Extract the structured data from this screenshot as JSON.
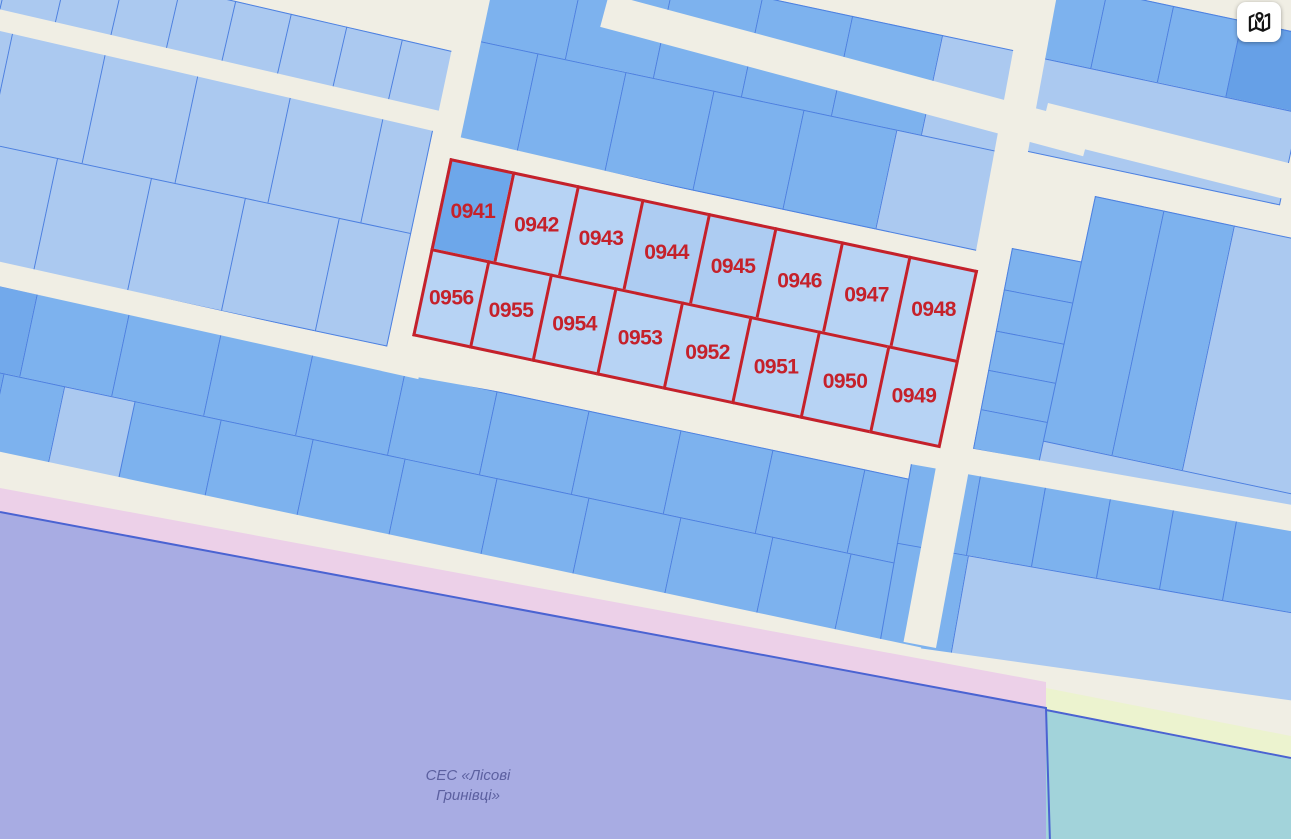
{
  "map": {
    "street_color": "#f0eee4",
    "parcel_border_color": "#4d80e0",
    "red_outline_color": "#c5212a",
    "palette": {
      "light": "#abc9f0",
      "light2": "#b7d3f4",
      "light3": "#adccf2",
      "med": "#7db2ee",
      "med2": "#72a9eb",
      "dark": "#66a0e7",
      "medDark": "#6da7ea"
    },
    "highlighted_parcels": [
      "0941",
      "0942",
      "0943",
      "0944",
      "0945",
      "0946",
      "0947",
      "0948",
      "0949",
      "0950",
      "0951",
      "0952",
      "0953",
      "0954",
      "0955",
      "0956"
    ],
    "blocks": [
      {
        "name": "block-nw-strip",
        "x": -20,
        "y": -58,
        "angle": 13,
        "rows": [
          {
            "h": 74,
            "cells": [
              {
                "w": 34,
                "c": "light"
              },
              {
                "w": 57,
                "c": "light"
              },
              {
                "w": 57,
                "c": "light"
              },
              {
                "w": 57,
                "c": "light"
              },
              {
                "w": 57,
                "c": "light"
              },
              {
                "w": 57,
                "c": "light"
              },
              {
                "w": 57,
                "c": "light"
              },
              {
                "w": 57,
                "c": "light"
              },
              {
                "w": 57,
                "c": "light"
              },
              {
                "w": 40,
                "c": "light"
              }
            ]
          }
        ]
      },
      {
        "name": "block-west-upper",
        "x": -15,
        "y": 26,
        "angle": 12,
        "rows": [
          {
            "h": 114,
            "cells": [
              {
                "w": 28,
                "c": "light"
              },
              {
                "w": 95,
                "c": "light"
              },
              {
                "w": 95,
                "c": "light"
              },
              {
                "w": 95,
                "c": "light"
              },
              {
                "w": 95,
                "c": "light"
              },
              {
                "w": 52,
                "c": "light"
              }
            ]
          },
          {
            "h": 116,
            "cells": [
              {
                "w": 16,
                "c": "light"
              },
              {
                "w": 82,
                "c": "light"
              },
              {
                "w": 96,
                "c": "light"
              },
              {
                "w": 96,
                "c": "light"
              },
              {
                "w": 96,
                "c": "light"
              },
              {
                "w": 74,
                "c": "light"
              }
            ]
          }
        ]
      },
      {
        "name": "block-north-central",
        "x": 500,
        "y": -59,
        "angle": 12,
        "rows": [
          {
            "h": 102,
            "cells": [
              {
                "w": 88,
                "c": "med"
              },
              {
                "w": 90,
                "c": "med"
              },
              {
                "w": 90,
                "c": "med"
              },
              {
                "w": 92,
                "c": "med"
              },
              {
                "w": 92,
                "c": "med"
              },
              {
                "w": 93,
                "c": "light"
              }
            ]
          },
          {
            "h": 102,
            "cells": [
              {
                "w": 60,
                "c": "med"
              },
              {
                "w": 90,
                "c": "med"
              },
              {
                "w": 90,
                "c": "med"
              },
              {
                "w": 92,
                "c": "med"
              },
              {
                "w": 95,
                "c": "med"
              },
              {
                "w": 118,
                "c": "light"
              }
            ]
          }
        ]
      },
      {
        "name": "block-northeast",
        "x": 1042,
        "y": -22,
        "angle": 12,
        "rows": [
          {
            "h": 78,
            "cells": [
              {
                "w": 66,
                "c": "med"
              },
              {
                "w": 68,
                "c": "med"
              },
              {
                "w": 70,
                "c": "med"
              },
              {
                "w": 76,
                "c": "dark"
              }
            ]
          },
          {
            "h": 95,
            "cells": [
              {
                "w": 280,
                "c": "light"
              }
            ]
          }
        ]
      },
      {
        "name": "block-east-strips",
        "x": 1012,
        "y": 248,
        "angle": 11,
        "rows": [
          {
            "h": 42,
            "cells": [
              {
                "w": 96,
                "c": "med"
              }
            ]
          },
          {
            "h": 42,
            "cells": [
              {
                "w": 96,
                "c": "med"
              }
            ]
          },
          {
            "h": 40,
            "cells": [
              {
                "w": 96,
                "c": "med"
              }
            ]
          },
          {
            "h": 40,
            "cells": [
              {
                "w": 96,
                "c": "med"
              }
            ]
          },
          {
            "h": 41,
            "cells": [
              {
                "w": 96,
                "c": "med"
              }
            ]
          }
        ]
      },
      {
        "name": "block-east-large",
        "x": 1095,
        "y": 196,
        "angle": 12,
        "rows": [
          {
            "h": 250,
            "cells": [
              {
                "w": 70,
                "c": "med"
              },
              {
                "w": 72,
                "c": "med"
              },
              {
                "w": 130,
                "c": "light"
              }
            ]
          },
          {
            "h": 130,
            "cells": [
              {
                "w": 272,
                "c": "light"
              }
            ]
          }
        ]
      },
      {
        "name": "block-west-lower",
        "x": -12,
        "y": 283,
        "angle": 12,
        "rows": [
          {
            "h": 85,
            "cells": [
              {
                "w": 50,
                "c": "med2"
              },
              {
                "w": 94,
                "c": "med"
              },
              {
                "w": 94,
                "c": "med"
              },
              {
                "w": 94,
                "c": "med"
              },
              {
                "w": 94,
                "c": "med"
              },
              {
                "w": 94,
                "c": "med"
              },
              {
                "w": 94,
                "c": "med"
              },
              {
                "w": 94,
                "c": "med"
              },
              {
                "w": 94,
                "c": "med"
              },
              {
                "w": 94,
                "c": "med"
              },
              {
                "w": 84,
                "c": "med"
              }
            ]
          },
          {
            "h": 85,
            "cells": [
              {
                "w": 34,
                "c": "med2"
              },
              {
                "w": 62,
                "c": "med"
              },
              {
                "w": 72,
                "c": "light"
              },
              {
                "w": 88,
                "c": "med"
              },
              {
                "w": 94,
                "c": "med"
              },
              {
                "w": 94,
                "c": "med"
              },
              {
                "w": 94,
                "c": "med"
              },
              {
                "w": 94,
                "c": "med"
              },
              {
                "w": 94,
                "c": "med"
              },
              {
                "w": 94,
                "c": "med"
              },
              {
                "w": 80,
                "c": "med"
              },
              {
                "w": 80,
                "c": "med"
              }
            ]
          }
        ]
      },
      {
        "name": "block-southeast",
        "x": 912,
        "y": 458,
        "angle": 10,
        "rows": [
          {
            "h": 86,
            "cells": [
              {
                "w": 70,
                "c": "med"
              },
              {
                "w": 66,
                "c": "med"
              },
              {
                "w": 66,
                "c": "med"
              },
              {
                "w": 64,
                "c": "med"
              },
              {
                "w": 64,
                "c": "med"
              },
              {
                "w": 90,
                "c": "med"
              }
            ]
          },
          {
            "h": 178,
            "cells": [
              {
                "w": 72,
                "c": "med"
              },
              {
                "w": 348,
                "c": "light"
              }
            ]
          }
        ]
      },
      {
        "name": "block-highlighted",
        "x": 450,
        "y": 158,
        "angle": 12,
        "highlight": true,
        "rows": [
          {
            "h": 92,
            "cells": [
              {
                "w": 64,
                "c": "medDark",
                "label": "0941"
              },
              {
                "w": 66,
                "c": "light2",
                "label": "0942"
              },
              {
                "w": 66,
                "c": "light2",
                "label": "0943"
              },
              {
                "w": 68,
                "c": "light3",
                "label": "0944"
              },
              {
                "w": 68,
                "c": "light3",
                "label": "0945"
              },
              {
                "w": 68,
                "c": "light2",
                "label": "0946"
              },
              {
                "w": 69,
                "c": "light2",
                "label": "0947"
              },
              {
                "w": 71,
                "c": "light2",
                "label": "0948"
              }
            ]
          },
          {
            "h": 90,
            "cells": [
              {
                "w": 58,
                "c": "light2",
                "label": "0956"
              },
              {
                "w": 64,
                "c": "light2",
                "label": "0955"
              },
              {
                "w": 66,
                "c": "light2",
                "label": "0954"
              },
              {
                "w": 68,
                "c": "light2",
                "label": "0953"
              },
              {
                "w": 70,
                "c": "light2",
                "label": "0952"
              },
              {
                "w": 70,
                "c": "light2",
                "label": "0951"
              },
              {
                "w": 71,
                "c": "light2",
                "label": "0950"
              },
              {
                "w": 73,
                "c": "light2",
                "label": "0949"
              }
            ]
          }
        ]
      }
    ],
    "streets": [
      {
        "name": "street-nw",
        "x": -6,
        "y": 8,
        "angle": 13,
        "len": 480,
        "w": 21
      },
      {
        "name": "street-cross-west",
        "x": 464,
        "y": -8,
        "angle": 12,
        "len": 185,
        "w": 27,
        "vert": true
      },
      {
        "name": "street-above-highlight",
        "x": 446,
        "y": 134,
        "angle": 13,
        "len": 548,
        "w": 22
      },
      {
        "name": "street-north-central",
        "x": 609,
        "y": -6,
        "angle": 15,
        "len": 500,
        "w": 34
      },
      {
        "name": "street-northeast",
        "x": 1048,
        "y": 103,
        "angle": 14,
        "len": 270,
        "w": 36
      },
      {
        "name": "street-cross-east",
        "x": 1024,
        "y": -8,
        "angle": 10.5,
        "len": 661,
        "w": 33,
        "vert": true
      },
      {
        "name": "street-mid-west",
        "x": -8,
        "y": 260,
        "angle": 12.5,
        "len": 442,
        "w": 24
      },
      {
        "name": "street-below-highlight",
        "x": 402,
        "y": 348,
        "angle": 10,
        "len": 912,
        "w": 26
      },
      {
        "name": "street-south-west",
        "x": -8,
        "y": 450,
        "angle": 12,
        "len": 950,
        "w": 40
      },
      {
        "name": "street-south-east",
        "x": 918,
        "y": 648,
        "angle": 8,
        "len": 385,
        "w": 42
      }
    ],
    "zones": {
      "pink_strip": {
        "points": "0,488 1046,682 1046,710 0,514",
        "color": "#ecd0e8"
      },
      "purple_area": {
        "points": "0,512 1046,708 1050,843 -6,843",
        "color": "#a8ace3"
      },
      "yellow_strip": {
        "points": "1046,688 1291,736 1291,762 1046,713",
        "color": "#ecf3cf"
      },
      "teal_area": {
        "points": "1046,711 1291,759 1291,843 1046,843",
        "color": "#a2d3da"
      },
      "purple_edge": {
        "points": "0,512 1046,708 1050,843",
        "color": "#4a63d2"
      },
      "teal_edge": {
        "points": "1046,710 1291,758",
        "color": "#4a63d2"
      }
    },
    "area_label": {
      "line1": "СЕС «Лісові",
      "line2": "Гринівці»",
      "color": "#5c60a0"
    },
    "button": {
      "icon": "map-pin-icon"
    }
  }
}
